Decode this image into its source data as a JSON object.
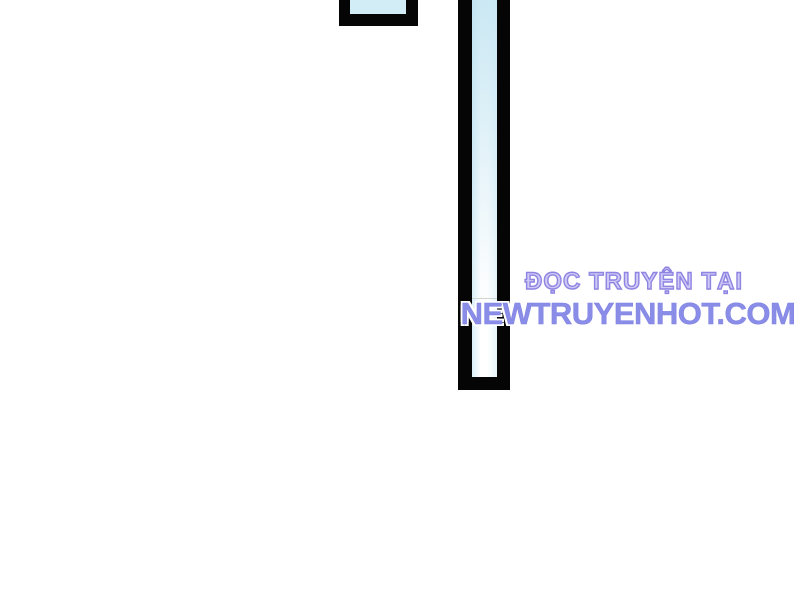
{
  "canvas": {
    "width_px": 800,
    "height_px": 600,
    "background": "#ffffff"
  },
  "artwork": {
    "type": "manga-panel-fragments",
    "ink_color": "#050505",
    "panel_fill_color": "#d3edf6",
    "bar_fade_to": "#ffffff"
  },
  "watermark": {
    "line1": "ĐỌC TRUYỆN TẠI",
    "line2": "NEWTRUYENHOT.COM",
    "line1_fill": "#cfc9f6",
    "line1_outline": "#8e84e2",
    "line2_color": "#8a8de7"
  }
}
